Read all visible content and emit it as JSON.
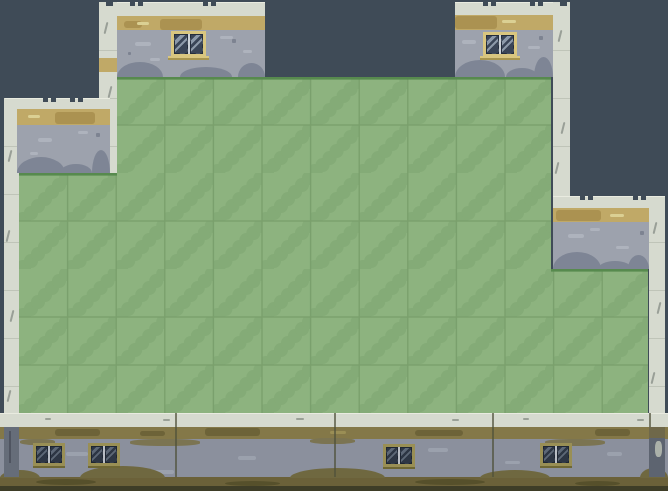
{
  "scene": {
    "title": "tile-platformer-level",
    "canvas": {
      "width": 668,
      "height": 491
    },
    "palette": {
      "background": "#3f4b57",
      "grass_base": "#8db37f",
      "grass_cloud": "#84ab77",
      "grass_grid": "#7aa06d",
      "grass_edge": "#578a4e",
      "stone_light": "#d6dacf",
      "stone_seam": "#bfc4b8",
      "stone_crack": "#8a9088",
      "concrete": "#9da2ad",
      "concrete_light": "#aeb3bd",
      "concrete_fleck": "#7d8391",
      "concrete_mound": "#7e8595",
      "bottom_concrete": "#8b909d",
      "bottom_concrete_light": "#9ba1ad",
      "tan": "#c0a967",
      "tan_dark": "#ab9251",
      "tan_light": "#dbd093",
      "olive_stripe": "#847848",
      "olive_dark": "#6d6338",
      "olive_light_dash": "#9a8e55",
      "olive_stain": "#7b7452",
      "ground": "#6b6139",
      "ground_blob": "#56502b",
      "base_dark": "#3e3d27",
      "mound_olive": "#6f6840",
      "band_dash": "#9aa096",
      "band_highlight": "#e9ebe0",
      "seam_line": "#50513b",
      "col_shadow_left": "#666d79",
      "col_shadow_right": "#5d6470",
      "col_shadow_olive": "#6f684a",
      "crack_dark": "#3f4550"
    },
    "window_styles": {
      "light": {
        "frame": "#d9c67f",
        "edge": "#a8954f",
        "glass": "#3a4557",
        "shine": "#8c99a9",
        "divider": "#ccd2d8",
        "sill": true
      },
      "olive": {
        "frame": "#998f55",
        "edge": "#6e6734",
        "glass": "#2d3644",
        "shine": "#5d6877",
        "divider": "#b9bec5",
        "sill": false
      }
    },
    "grass": {
      "origin": {
        "x": 19,
        "y": 77
      },
      "cell_w": 48.6,
      "cell_h": 48,
      "cloud": [
        [
          4,
          47,
          8
        ],
        [
          12,
          40,
          7
        ],
        [
          19,
          33,
          7
        ],
        [
          26,
          26,
          7
        ],
        [
          33,
          19,
          7
        ],
        [
          40,
          12,
          7
        ],
        [
          47,
          5,
          7
        ],
        [
          53,
          -1,
          6
        ]
      ],
      "regions": [
        {
          "x": 117,
          "y": 77,
          "w": 434,
          "h": 96,
          "edges": [
            {
              "x": 117,
              "w": 434
            }
          ]
        },
        {
          "x": 19,
          "y": 173,
          "w": 532,
          "h": 96,
          "edges": [
            {
              "x": 19,
              "w": 98
            }
          ]
        },
        {
          "x": 19,
          "y": 269,
          "w": 629,
          "h": 145,
          "edges": [
            {
              "x": 551,
              "w": 97
            }
          ]
        }
      ]
    },
    "columns": [
      {
        "name": "left-edge-column",
        "x": 4,
        "y": 98,
        "w": 15,
        "h": 329,
        "cracks": [
          [
            9,
            150
          ],
          [
            7,
            230
          ],
          [
            11,
            310
          ],
          [
            8,
            390
          ]
        ]
      },
      {
        "name": "top-left-inner-column",
        "x": 99,
        "y": 2,
        "w": 18,
        "h": 171,
        "notch": 106,
        "cracks": [
          [
            105,
            22
          ],
          [
            109,
            86
          ],
          [
            103,
            132
          ]
        ],
        "tan_patch": {
          "y": 58,
          "h": 14
        }
      },
      {
        "name": "mid-right-column",
        "x": 553,
        "y": 2,
        "w": 17,
        "h": 194,
        "notch": 560,
        "cracks": [
          [
            559,
            30
          ],
          [
            562,
            122
          ],
          [
            556,
            162
          ]
        ]
      },
      {
        "name": "right-edge-column",
        "x": 649,
        "y": 196,
        "w": 16,
        "h": 231,
        "notch": 655,
        "cracks": [
          [
            654,
            222
          ],
          [
            658,
            302
          ],
          [
            652,
            372
          ]
        ]
      }
    ],
    "column_shadows": [
      {
        "x": 4,
        "y": 427,
        "w": 15,
        "h": 50,
        "color_key": "col_shadow_left",
        "crack": {
          "x": 9,
          "y": 431,
          "w": 2,
          "h": 32
        }
      },
      {
        "x": 649,
        "y": 427,
        "w": 16,
        "h": 11,
        "color_key": "col_shadow_olive"
      },
      {
        "x": 649,
        "y": 438,
        "w": 16,
        "h": 39,
        "color_key": "col_shadow_right",
        "blob": {
          "x": 655,
          "y": 441,
          "w": 7,
          "h": 16
        }
      }
    ],
    "walls": [
      {
        "name": "top-left-wall",
        "x": 117,
        "y": 2,
        "w": 148,
        "h": 75,
        "top_h": 14,
        "stripe_h": 14,
        "notches": [
          130,
          203
        ],
        "stripe_dark": [
          {
            "x": 160,
            "y": 19,
            "w": 42,
            "h": 11
          },
          {
            "x": 124,
            "y": 21,
            "w": 18,
            "h": 7
          }
        ],
        "stripe_light": [
          {
            "x": 137,
            "y": 22,
            "w": 12,
            "h": 3
          }
        ],
        "patches": [
          {
            "x": 135,
            "y": 42,
            "w": 16,
            "h": 4
          },
          {
            "x": 220,
            "y": 36,
            "w": 13,
            "h": 3
          },
          {
            "x": 150,
            "y": 58,
            "w": 10,
            "h": 3
          },
          {
            "x": 243,
            "y": 50,
            "w": 9,
            "h": 3
          }
        ],
        "flecks": [
          {
            "x": 232,
            "y": 39,
            "w": 4,
            "h": 4
          },
          {
            "x": 128,
            "y": 52,
            "w": 3,
            "h": 3
          }
        ],
        "mounds": [
          {
            "x": 117,
            "y": 62,
            "w": 46,
            "h": 15
          },
          {
            "x": 180,
            "y": 67,
            "w": 52,
            "h": 10
          },
          {
            "x": 238,
            "y": 63,
            "w": 27,
            "h": 14
          }
        ],
        "window": {
          "x": 171,
          "y": 31,
          "w": 35,
          "h": 28,
          "style": "light"
        }
      },
      {
        "name": "top-right-wall",
        "x": 455,
        "y": 2,
        "w": 98,
        "h": 75,
        "top_h": 13,
        "stripe_h": 15,
        "notches": [
          483,
          530
        ],
        "stripe_dark": [
          {
            "x": 455,
            "y": 16,
            "w": 42,
            "h": 13
          }
        ],
        "stripe_light": [
          {
            "x": 502,
            "y": 20,
            "w": 14,
            "h": 3
          }
        ],
        "patches": [
          {
            "x": 462,
            "y": 40,
            "w": 14,
            "h": 4
          },
          {
            "x": 528,
            "y": 46,
            "w": 12,
            "h": 3
          },
          {
            "x": 470,
            "y": 62,
            "w": 10,
            "h": 3
          }
        ],
        "flecks": [
          {
            "x": 539,
            "y": 36,
            "w": 4,
            "h": 4
          }
        ],
        "mounds": [
          {
            "x": 455,
            "y": 60,
            "w": 50,
            "h": 17
          },
          {
            "x": 506,
            "y": 68,
            "w": 32,
            "h": 9
          },
          {
            "x": 534,
            "y": 57,
            "w": 19,
            "h": 20
          }
        ],
        "window": {
          "x": 483,
          "y": 32,
          "w": 34,
          "h": 27,
          "style": "light"
        }
      },
      {
        "name": "left-wall",
        "x": 17,
        "y": 98,
        "w": 93,
        "h": 75,
        "top_h": 11,
        "stripe_h": 16,
        "band": {
          "x": 5,
          "w": 105
        },
        "notches": [
          43,
          70
        ],
        "stripe_dark": [
          {
            "x": 55,
            "y": 112,
            "w": 40,
            "h": 12
          }
        ],
        "stripe_light": [
          {
            "x": 28,
            "y": 115,
            "w": 12,
            "h": 3
          }
        ],
        "patches": [
          {
            "x": 38,
            "y": 138,
            "w": 14,
            "h": 4
          },
          {
            "x": 78,
            "y": 131,
            "w": 10,
            "h": 3
          },
          {
            "x": 30,
            "y": 152,
            "w": 8,
            "h": 3
          }
        ],
        "flecks": [
          {
            "x": 96,
            "y": 133,
            "w": 4,
            "h": 4
          }
        ],
        "mounds": [
          {
            "x": 17,
            "y": 157,
            "w": 48,
            "h": 16
          },
          {
            "x": 60,
            "y": 164,
            "w": 32,
            "h": 9
          },
          {
            "x": 92,
            "y": 150,
            "w": 18,
            "h": 23
          }
        ]
      },
      {
        "name": "right-wall",
        "x": 553,
        "y": 196,
        "w": 96,
        "h": 73,
        "top_h": 12,
        "stripe_h": 14,
        "band": {
          "x": 553,
          "w": 112
        },
        "notches": [
          580,
          633
        ],
        "stripe_dark": [
          {
            "x": 556,
            "y": 210,
            "w": 45,
            "h": 11
          }
        ],
        "stripe_light": [
          {
            "x": 610,
            "y": 214,
            "w": 14,
            "h": 3
          }
        ],
        "patches": [
          {
            "x": 568,
            "y": 234,
            "w": 16,
            "h": 4
          },
          {
            "x": 616,
            "y": 246,
            "w": 13,
            "h": 3
          },
          {
            "x": 590,
            "y": 228,
            "w": 10,
            "h": 3
          }
        ],
        "flecks": [
          {
            "x": 640,
            "y": 231,
            "w": 4,
            "h": 4
          }
        ],
        "mounds": [
          {
            "x": 553,
            "y": 252,
            "w": 48,
            "h": 17
          },
          {
            "x": 598,
            "y": 261,
            "w": 34,
            "h": 8
          },
          {
            "x": 628,
            "y": 255,
            "w": 21,
            "h": 14
          }
        ]
      }
    ],
    "bottom_wall": {
      "y": 413,
      "light_h": 14,
      "stripe_h": 12,
      "concrete_h": 38,
      "ground_h": 9,
      "base_h": 5,
      "seams": [
        175,
        334,
        492,
        649
      ],
      "dashes": [
        {
          "x": 45,
          "y": 418,
          "w": 6,
          "h": 2
        },
        {
          "x": 163,
          "y": 419,
          "w": 7,
          "h": 2
        },
        {
          "x": 296,
          "y": 418,
          "w": 8,
          "h": 2
        },
        {
          "x": 452,
          "y": 419,
          "w": 7,
          "h": 2
        },
        {
          "x": 523,
          "y": 418,
          "w": 6,
          "h": 2
        },
        {
          "x": 637,
          "y": 419,
          "w": 7,
          "h": 2
        }
      ],
      "stripe_dark": [
        {
          "x": 55,
          "y": 429,
          "w": 45,
          "h": 7
        },
        {
          "x": 205,
          "y": 428,
          "w": 55,
          "h": 8
        },
        {
          "x": 415,
          "y": 430,
          "w": 48,
          "h": 6
        },
        {
          "x": 595,
          "y": 429,
          "w": 35,
          "h": 7
        },
        {
          "x": 140,
          "y": 431,
          "w": 25,
          "h": 5
        }
      ],
      "stripe_light": [
        {
          "x": 330,
          "y": 431,
          "w": 16,
          "h": 3
        }
      ],
      "stains": [
        {
          "x": 20,
          "y": 439,
          "w": 35,
          "h": 6
        },
        {
          "x": 130,
          "y": 439,
          "w": 70,
          "h": 7
        },
        {
          "x": 310,
          "y": 438,
          "w": 45,
          "h": 6
        },
        {
          "x": 545,
          "y": 439,
          "w": 60,
          "h": 7
        }
      ],
      "smudges": [
        {
          "x": 66,
          "y": 452,
          "w": 22,
          "h": 4
        },
        {
          "x": 238,
          "y": 456,
          "w": 18,
          "h": 4
        },
        {
          "x": 428,
          "y": 448,
          "w": 20,
          "h": 4
        },
        {
          "x": 505,
          "y": 461,
          "w": 15,
          "h": 3
        },
        {
          "x": 607,
          "y": 452,
          "w": 15,
          "h": 4
        },
        {
          "x": 150,
          "y": 470,
          "w": 24,
          "h": 4
        }
      ],
      "mounds": [
        {
          "x": 0,
          "y": 470,
          "w": 40,
          "h": 8
        },
        {
          "x": 80,
          "y": 466,
          "w": 85,
          "h": 12
        },
        {
          "x": 290,
          "y": 468,
          "w": 95,
          "h": 10
        },
        {
          "x": 480,
          "y": 470,
          "w": 70,
          "h": 8
        },
        {
          "x": 640,
          "y": 468,
          "w": 28,
          "h": 10
        }
      ],
      "blobs": [
        {
          "x": 36,
          "y": 479,
          "w": 60,
          "h": 6
        },
        {
          "x": 225,
          "y": 481,
          "w": 55,
          "h": 5
        },
        {
          "x": 415,
          "y": 479,
          "w": 70,
          "h": 6
        },
        {
          "x": 575,
          "y": 481,
          "w": 45,
          "h": 5
        }
      ],
      "windows": [
        {
          "x": 33,
          "y": 443
        },
        {
          "x": 88,
          "y": 443
        },
        {
          "x": 383,
          "y": 444
        },
        {
          "x": 540,
          "y": 443
        }
      ],
      "win_w": 32,
      "win_h": 25,
      "win_style": "olive"
    }
  }
}
